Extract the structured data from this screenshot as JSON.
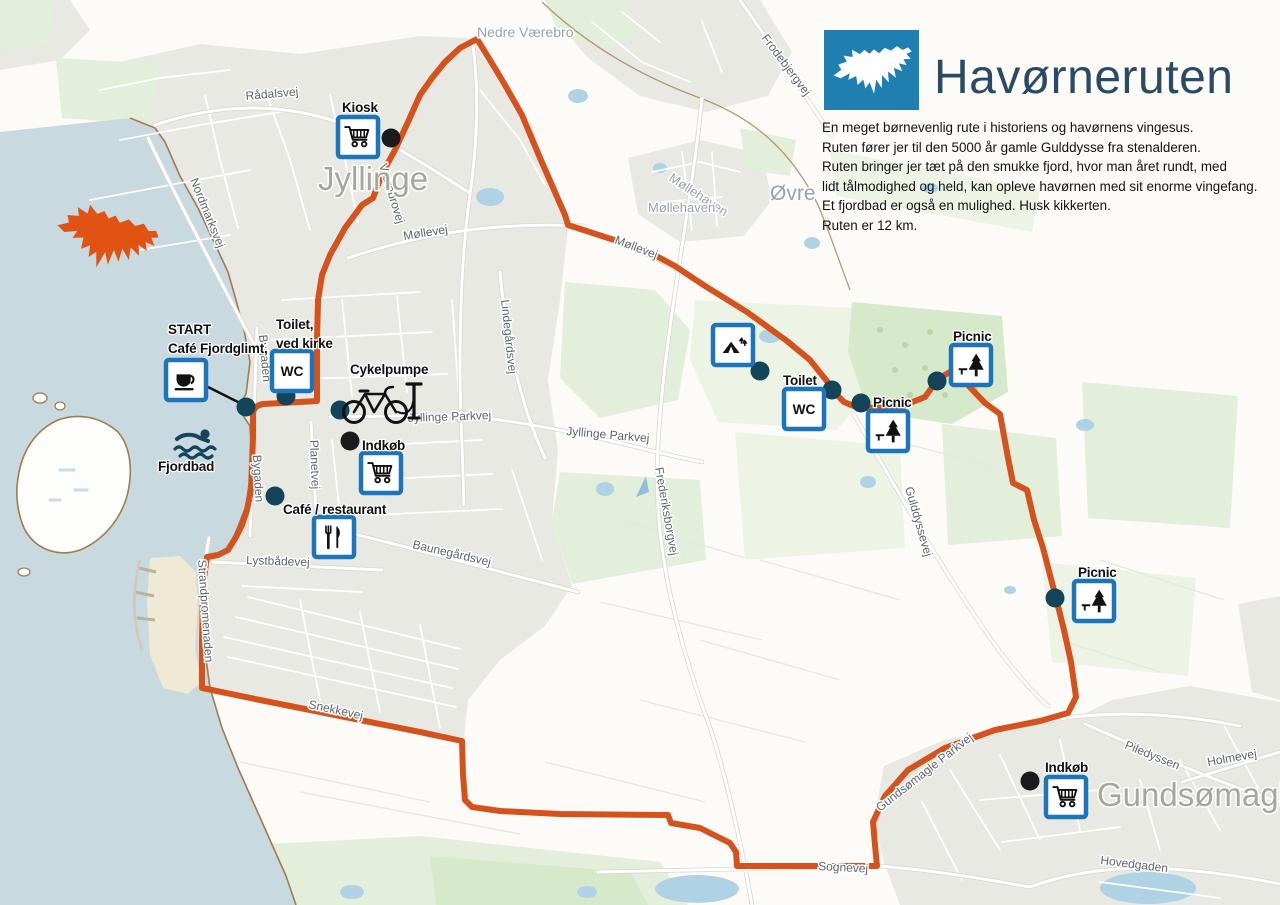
{
  "header": {
    "title": "Havørneruten",
    "logo_icon": "eagle-logo",
    "description_lines": [
      "En meget børnevenlig rute i historiens og havørnens vingesus.",
      "Ruten fører jer til den 5000 år gamle Gulddysse fra stenalderen.",
      "Ruten bringer jer tæt på den smukke fjord, hvor man året rundt, med",
      "lidt tålmodighed og held, kan opleve havørnen med sit enorme vingefang.",
      "Et fjordbad er også en mulighed. Husk kikkerten.",
      "Ruten er 12 km."
    ]
  },
  "map": {
    "wc_label": "WC",
    "colors": {
      "route": "#D6521D",
      "eagle": "#E05313",
      "water": "#C9D9E0",
      "pond": "#AFD3E4",
      "urban": "#E9E9E3",
      "green": "#E3EFDB",
      "green_pale": "#EDF4E6",
      "green_dark": "#D6E9CB",
      "poi_dot": "#144459",
      "poi_dot_black": "#1A1A1A",
      "box_border": "#1C74BB",
      "logo_blue": "#1E7FB0",
      "title_text": "#2A4A66"
    },
    "places": [
      {
        "label": "Jyllinge",
        "x": 318,
        "y": 190,
        "size": 33,
        "color": "#A6A69E"
      },
      {
        "label": "Gundsømagle",
        "x": 1097,
        "y": 806,
        "size": 33,
        "color": "#A6A69E"
      },
      {
        "label": "Nedre Værebro",
        "x": 477,
        "y": 37,
        "size": 14,
        "color": "#99A3A4"
      },
      {
        "label": "Møllehaven",
        "x": 668,
        "y": 180,
        "size": 13,
        "rot": 33,
        "color": "#99A3A4"
      },
      {
        "label": "Møllehaven",
        "x": 648,
        "y": 212,
        "size": 13,
        "color": "#99A3A4"
      },
      {
        "label": "Øvre",
        "x": 770,
        "y": 200,
        "size": 21,
        "color": "#99A3A4"
      }
    ],
    "roads": [
      {
        "label": "Rådalsvej",
        "x": 246,
        "y": 100,
        "rot": -5
      },
      {
        "label": "Nordmarksvej",
        "x": 190,
        "y": 180,
        "rot": 68
      },
      {
        "label": "Værebrovej",
        "x": 379,
        "y": 165,
        "rot": 73
      },
      {
        "label": "Møllevej",
        "x": 404,
        "y": 240,
        "rot": -9
      },
      {
        "label": "Møllevej",
        "x": 614,
        "y": 243,
        "rot": 21
      },
      {
        "label": "Lindegårdsvej",
        "x": 501,
        "y": 300,
        "rot": 84
      },
      {
        "label": "Frodebjergvej",
        "x": 761,
        "y": 38,
        "rot": 53
      },
      {
        "label": "Jyllinge Parkvej",
        "x": 408,
        "y": 422,
        "rot": -2
      },
      {
        "label": "Jyllinge Parkvej",
        "x": 566,
        "y": 435,
        "rot": 5
      },
      {
        "label": "Frederiksborgvej",
        "x": 655,
        "y": 468,
        "rot": 80
      },
      {
        "label": "Baunegårdsvej",
        "x": 412,
        "y": 548,
        "rot": 13
      },
      {
        "label": "Lystbådevej",
        "x": 246,
        "y": 564,
        "rot": 2
      },
      {
        "label": "Bygaden",
        "x": 259,
        "y": 335,
        "rot": 85
      },
      {
        "label": "Bygaden",
        "x": 253,
        "y": 455,
        "rot": 87
      },
      {
        "label": "Planetvej",
        "x": 310,
        "y": 440,
        "rot": 88
      },
      {
        "label": "Strandpromenaden",
        "x": 198,
        "y": 560,
        "rot": 86
      },
      {
        "label": "Snekkevej",
        "x": 308,
        "y": 708,
        "rot": 12
      },
      {
        "label": "Gulddyssevej",
        "x": 905,
        "y": 488,
        "rot": 74
      },
      {
        "label": "Gundsømagle Parkvej",
        "x": 880,
        "y": 812,
        "rot": -38
      },
      {
        "label": "Sognevej",
        "x": 818,
        "y": 870,
        "rot": 3
      },
      {
        "label": "Piledyssen",
        "x": 1124,
        "y": 748,
        "rot": 22
      },
      {
        "label": "Holmevej",
        "x": 1208,
        "y": 766,
        "rot": -10
      },
      {
        "label": "Hovedgaden",
        "x": 1100,
        "y": 864,
        "rot": 7
      }
    ],
    "pois": [
      {
        "id": "kiosk",
        "icon": "cart",
        "label": [
          "Kiosk"
        ],
        "label_x": 342,
        "label_y": 112,
        "box_x": 338,
        "box_y": 117,
        "dot_x": 391,
        "dot_y": 138,
        "dot_color": "black"
      },
      {
        "id": "start-cafe-fjordglimt",
        "icon": "coffee",
        "label": [
          "START",
          "Café Fjordglimt,"
        ],
        "label_x": 168,
        "label_y": 334,
        "box_x": 166,
        "box_y": 360,
        "dot_x": 246,
        "dot_y": 407,
        "dot_color": "teal",
        "line": [
          208,
          387,
          240,
          403
        ]
      },
      {
        "id": "toilet-ved-kirke",
        "icon": "wc",
        "label": [
          "Toilet,",
          "ved kirke"
        ],
        "label_x": 276,
        "label_y": 329,
        "box_x": 272,
        "box_y": 351,
        "dot_x": 286,
        "dot_y": 396,
        "dot_color": "teal"
      },
      {
        "id": "cykelpumpe",
        "icon": "bike",
        "label": [
          "Cykelpumpe"
        ],
        "label_x": 350,
        "label_y": 374,
        "icon_x": 336,
        "icon_y": 376,
        "dot_x": 340,
        "dot_y": 410,
        "dot_color": "teal"
      },
      {
        "id": "indkob-jyllinge",
        "icon": "cart",
        "label": [
          "Indkøb"
        ],
        "label_x": 362,
        "label_y": 450,
        "box_x": 361,
        "box_y": 453,
        "dot_x": 350,
        "dot_y": 441,
        "dot_color": "black"
      },
      {
        "id": "cafe-restaurant",
        "icon": "utensils",
        "label": [
          "Café / restaurant"
        ],
        "label_x": 283,
        "label_y": 514,
        "box_x": 314,
        "box_y": 517,
        "dot_x": 275,
        "dot_y": 496,
        "dot_color": "teal"
      },
      {
        "id": "fjordbad",
        "icon": "swimmer",
        "label": [
          "Fjordbad"
        ],
        "label_x": 158,
        "label_y": 471,
        "icon_x": 172,
        "icon_y": 426,
        "dot_color": "none"
      },
      {
        "id": "shelter",
        "icon": "shelter",
        "label": [],
        "box_x": 713,
        "box_y": 325,
        "dot_x": 760,
        "dot_y": 371,
        "dot_color": "teal"
      },
      {
        "id": "toilet-gulddysse",
        "icon": "wc",
        "label": [
          "Toilet"
        ],
        "label_x": 783,
        "label_y": 385,
        "box_x": 784,
        "box_y": 389,
        "dot_x": 832,
        "dot_y": 390,
        "dot_color": "teal"
      },
      {
        "id": "picnic-gulddysse",
        "icon": "tree",
        "label": [
          "Picnic"
        ],
        "label_x": 873,
        "label_y": 407,
        "box_x": 868,
        "box_y": 411,
        "dot_x": 861,
        "dot_y": 403,
        "dot_color": "teal"
      },
      {
        "id": "picnic-nordost",
        "icon": "tree",
        "label": [
          "Picnic"
        ],
        "label_x": 953,
        "label_y": 341,
        "box_x": 951,
        "box_y": 345,
        "dot_x": 937,
        "dot_y": 381,
        "dot_color": "teal"
      },
      {
        "id": "picnic-sydost",
        "icon": "tree",
        "label": [
          "Picnic"
        ],
        "label_x": 1078,
        "label_y": 577,
        "box_x": 1074,
        "box_y": 581,
        "dot_x": 1055,
        "dot_y": 598,
        "dot_color": "teal"
      },
      {
        "id": "indkob-gundsomagle",
        "icon": "cart",
        "label": [
          "Indkøb"
        ],
        "label_x": 1045,
        "label_y": 772,
        "box_x": 1046,
        "box_y": 777,
        "dot_x": 1030,
        "dot_y": 781,
        "dot_color": "black"
      }
    ]
  }
}
